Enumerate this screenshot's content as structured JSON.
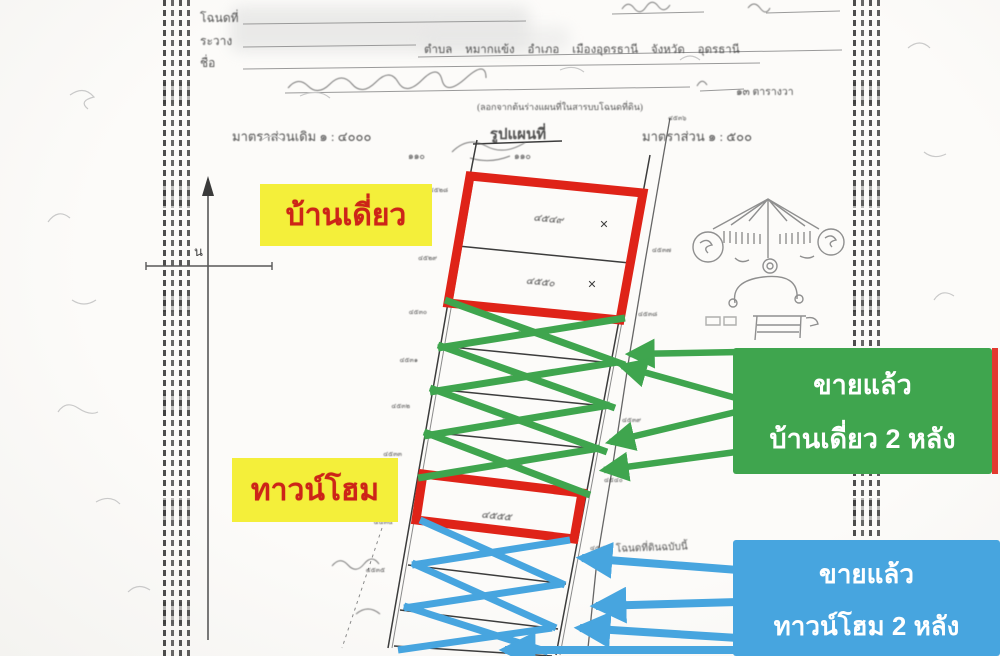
{
  "colors": {
    "red_outline": "#df2318",
    "green_accent": "#3fa54e",
    "blue_accent": "#47a5df",
    "yellow_label": "#f4ef3a",
    "label_text_red": "#cd2418"
  },
  "overlay": {
    "label_detached": "บ้านเดี่ยว",
    "label_townhome": "ทาวน์โฮม",
    "sold_detached": {
      "line1": "ขายแล้ว",
      "line2": "บ้านเดี่ยว 2 หลัง"
    },
    "sold_townhome": {
      "line1": "ขายแล้ว",
      "line2": "ทาวน์โฮม 2 หลัง"
    }
  },
  "form": {
    "deed_label": "โฉนดที่",
    "sheet_label": "ระวาง",
    "name_label": "ชื่อ",
    "location_line": "ตำบล หมากแข้ง อำเภอ เมืองอุดรธานี จังหวัด อุดรธานี",
    "copy_note": "(ลอกจากต้นร่างแผนที่ในสารบบโฉนดที่ดิน)",
    "scale_old": "มาตราส่วนเดิม ๑ : ๔๐๐๐",
    "map_heading": "รูปแผนที่",
    "scale_new": "มาตราส่วน ๑ : ๕๐๐",
    "tick_left": "๑๑๐",
    "tick_mid": "๑๑๐",
    "area_note": "๑๓ ตารางวา",
    "bottom_note": "โฉนดที่ดินฉบับนี้",
    "north_letter": "น",
    "cross_mark_1": "✕",
    "cross_mark_2": "✕"
  },
  "map": {
    "plot_numbers": [
      "๔๕๔๙",
      "๔๕๕๐",
      "๔๕๕๑",
      "๔๕๕๒",
      "๔๕๕๓",
      "๔๕๕๔",
      "๔๕๕๕"
    ],
    "marker_labels": [
      "๔๕๒๘",
      "๔๕๒๙",
      "๔๕๓๐",
      "๔๕๓๑",
      "๔๕๓๒",
      "๔๕๓๓",
      "๔๕๓๔",
      "๔๕๓๕",
      "๔๕๓๖",
      "๔๕๓๗",
      "๔๕๓๘",
      "๔๕๓๙",
      "๔๕๔๐",
      "๔๕๔๑"
    ]
  }
}
